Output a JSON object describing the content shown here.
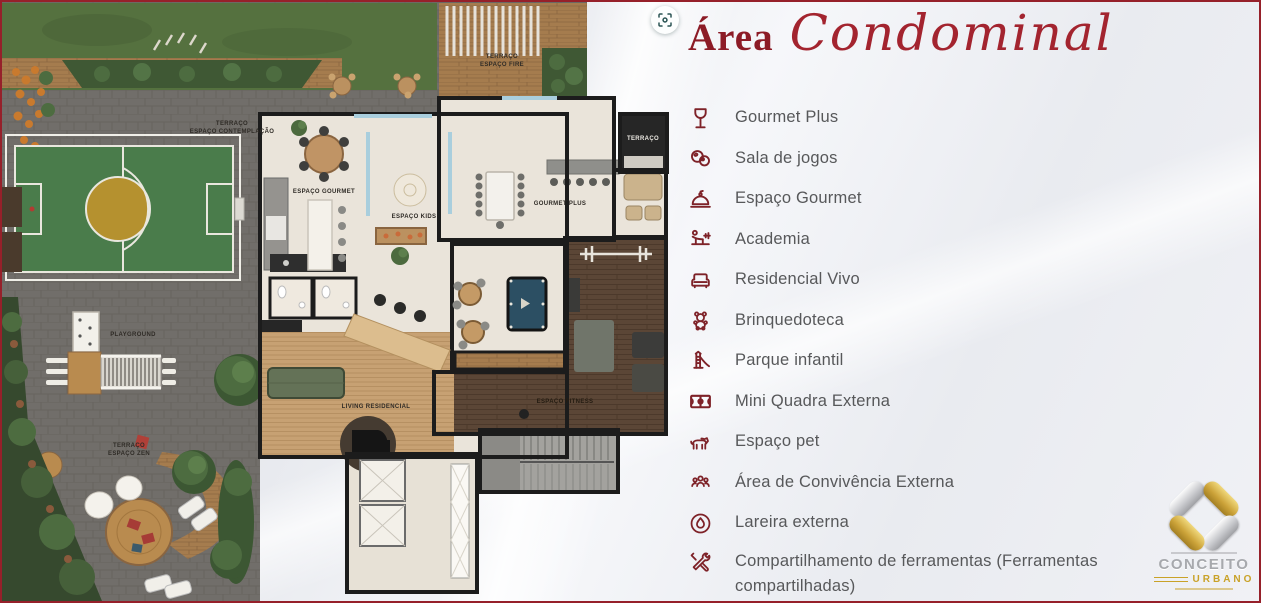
{
  "header": {
    "title_word": "Área",
    "title_script": "Condominal"
  },
  "amenities": [
    {
      "icon": "wine-glass-icon",
      "label": "Gourmet Plus"
    },
    {
      "icon": "billiard-balls-icon",
      "label": "Sala de jogos"
    },
    {
      "icon": "cloche-icon",
      "label": "Espaço Gourmet"
    },
    {
      "icon": "gym-bench-icon",
      "label": "Academia"
    },
    {
      "icon": "sofa-icon",
      "label": "Residencial Vivo"
    },
    {
      "icon": "teddy-bear-icon",
      "label": "Brinquedoteca"
    },
    {
      "icon": "slide-icon",
      "label": "Parque infantil"
    },
    {
      "icon": "sports-court-icon",
      "label": "Mini Quadra Externa"
    },
    {
      "icon": "dog-icon",
      "label": "Espaço pet"
    },
    {
      "icon": "people-group-icon",
      "label": "Área de Convivência Externa"
    },
    {
      "icon": "fire-icon",
      "label": "Lareira externa"
    },
    {
      "icon": "tools-icon",
      "label": "Compartilhamento de ferramentas (Ferramentas compartilhadas)"
    }
  ],
  "floor_plan": {
    "labels": {
      "terraco_contemplacao": {
        "line1": "TERRAÇO",
        "line2": "ESPAÇO CONTEMPLAÇÃO"
      },
      "terraco_fire": {
        "line1": "TERRAÇO",
        "line2": "ESPAÇO FIRE"
      },
      "espaco_gourmet": "ESPAÇO GOURMET",
      "espaco_kids": "ESPAÇO KIDS",
      "gourmet_plus": "GOURMET PLUS",
      "terraco": "TERRAÇO",
      "playground": "PLAYGROUND",
      "living_residencial": "LIVING RESIDENCIAL",
      "espaco_fitness": "ESPAÇO FITNESS",
      "terraco_zen": {
        "line1": "TERRAÇO",
        "line2": "ESPAÇO ZEN"
      }
    }
  },
  "logo": {
    "name": "CONCEITO",
    "subtitle": "URBANO"
  },
  "colors": {
    "accent_red": "#8c1b26",
    "icon_red": "#7e2228",
    "body_text": "#57585a",
    "logo_gold": "#c9a227",
    "border_red": "#96202a"
  }
}
